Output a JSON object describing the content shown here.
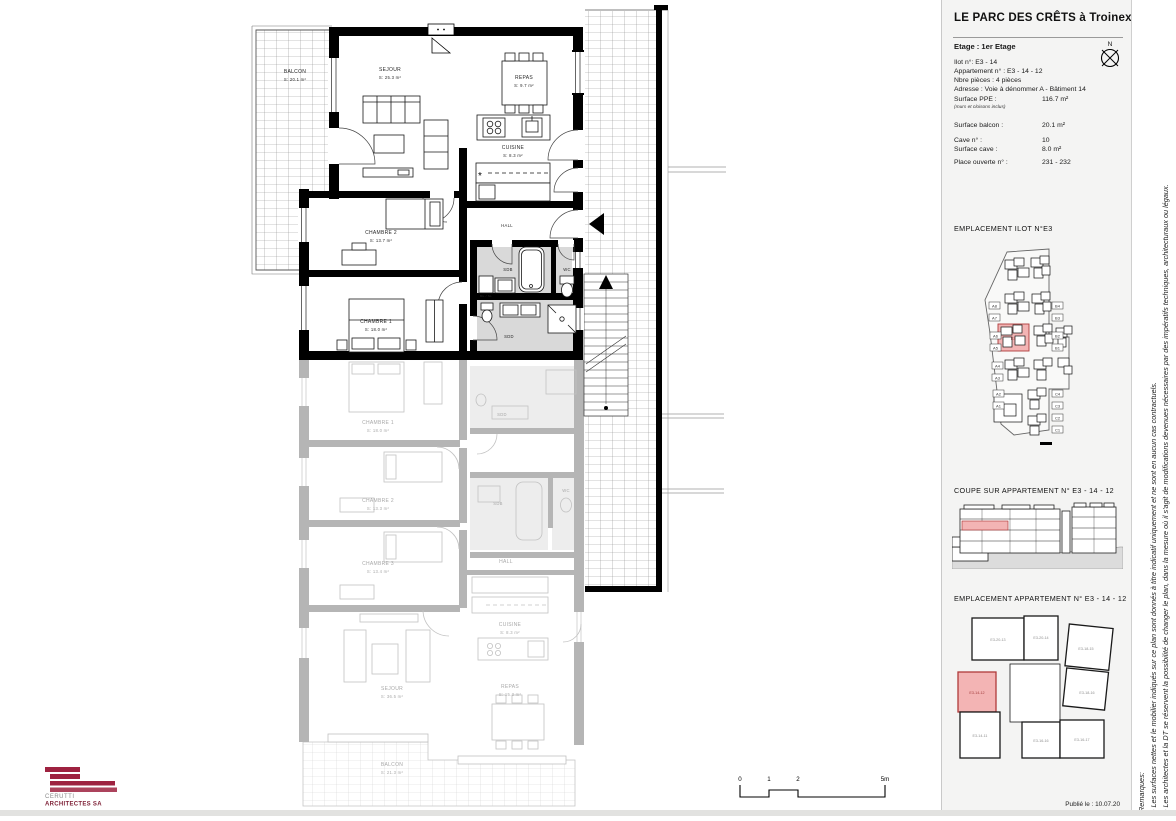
{
  "colors": {
    "highlight_fill": "#f3b4b4",
    "highlight_stroke": "#b03b3b",
    "logo_color": "#9e2240",
    "wet_fill": "#d9d9d9"
  },
  "plan": {
    "rooms": {
      "balcon": {
        "name": "BALCON",
        "area": "S: 20.1 m²"
      },
      "sejour": {
        "name": "SEJOUR",
        "area": "S: 25.3 m²"
      },
      "repas": {
        "name": "REPAS",
        "area": "S: 9.7 m²"
      },
      "cuisine": {
        "name": "CUISINE",
        "area": "S: 8.3 m²"
      },
      "chambre2": {
        "name": "CHAMBRE 2",
        "area": "S: 13.7 m²"
      },
      "chambre1": {
        "name": "CHAMBRE 1",
        "area": "S: 18.0 m²"
      },
      "hall": "HALL",
      "sdb": "SDB",
      "wc": "WC",
      "sdd": "SDD",
      "ml": "ML / SL"
    },
    "faded": {
      "chambre1": {
        "name": "CHAMBRE 1",
        "area": "S: 18.0 m²"
      },
      "chambre2": {
        "name": "CHAMBRE 2",
        "area": "S: 13.3 m²"
      },
      "chambre3": {
        "name": "CHAMBRE 3",
        "area": "S: 13.4 m²"
      },
      "hall": "HALL",
      "sdb": "SDB",
      "wc": "WC",
      "sdd": "SDD",
      "cuisine": {
        "name": "CUISINE",
        "area": "S: 8.3 m²"
      },
      "sejour": {
        "name": "SEJOUR",
        "area": "S: 36.5 m²"
      },
      "repas": {
        "name": "REPAS",
        "area": "S: 15.3 m²"
      },
      "balcon": {
        "name": "BALCON",
        "area": "S: 21.3 m²"
      }
    },
    "scalebar": {
      "t0": "0",
      "t1": "1",
      "t2": "2",
      "t5": "5m"
    }
  },
  "logo": {
    "line1": "CERUTTI",
    "line2": "ARCHITECTES SA"
  },
  "sidebar": {
    "title": "LE PARC DES CRÊTS à Troinex",
    "etage": "Etage : 1er Etage",
    "compass": "N",
    "info_lines": [
      "Ilot n°: E3 - 14",
      "Appartement n° : E3 - 14 - 12",
      "Nbre pièces : 4 pièces",
      "Adresse :  Voie à dénommer A - Bâtiment 14"
    ],
    "surface_ppe": {
      "label": "Surface PPE :",
      "value": "116.7 m²",
      "note": "(murs et cloisons inclus)"
    },
    "surface_balcon": {
      "label": "Surface balcon :",
      "value": "20.1 m²"
    },
    "cave_no": {
      "label": "Cave n° :",
      "value": "10"
    },
    "surface_cave": {
      "label": "Surface cave :",
      "value": "8.0 m²"
    },
    "place_ouverte": {
      "label": "Place ouverte n° :",
      "value": "231 - 232"
    },
    "section_ilot": {
      "heading": "EMPLACEMENT ILOT N°E3",
      "left_labels": [
        "A8",
        "A7",
        "A6",
        "A5",
        "A4",
        "A3",
        "A2",
        "A1"
      ],
      "right_labels": [
        "B4",
        "B3",
        "B2",
        "B1"
      ],
      "bottom_right_labels": [
        "C4",
        "C3",
        "C2",
        "C1"
      ],
      "highlight_label": "E3"
    },
    "section_coupe": {
      "heading": "COUPE SUR APPARTEMENT N° E3 - 14 - 12"
    },
    "section_apt": {
      "heading": "EMPLACEMENT APPARTEMENT N° E3 - 14 - 12",
      "units": [
        "E3-20-13",
        "E3-20-14",
        "E3-18-15",
        "E3-18-16",
        "E3-14-12",
        "E3-14-11",
        "E3-16-16",
        "E3-16-17"
      ]
    },
    "published": "Publié le : 10.07.20"
  },
  "remarks": {
    "title": "Remarques:",
    "line1": "- Les surfaces nettes et le mobilier indiqués sur ce plan sont donnés à titre indicatif uniquement et ne sont en aucun cas contractuels.",
    "line2": "- Les architectes et la DT se réservent la possibilité de changer le plan, dans la mesure où il s'agit de modifications devenues nécessaires par des impératifs techniques, architecturaux ou légaux."
  }
}
